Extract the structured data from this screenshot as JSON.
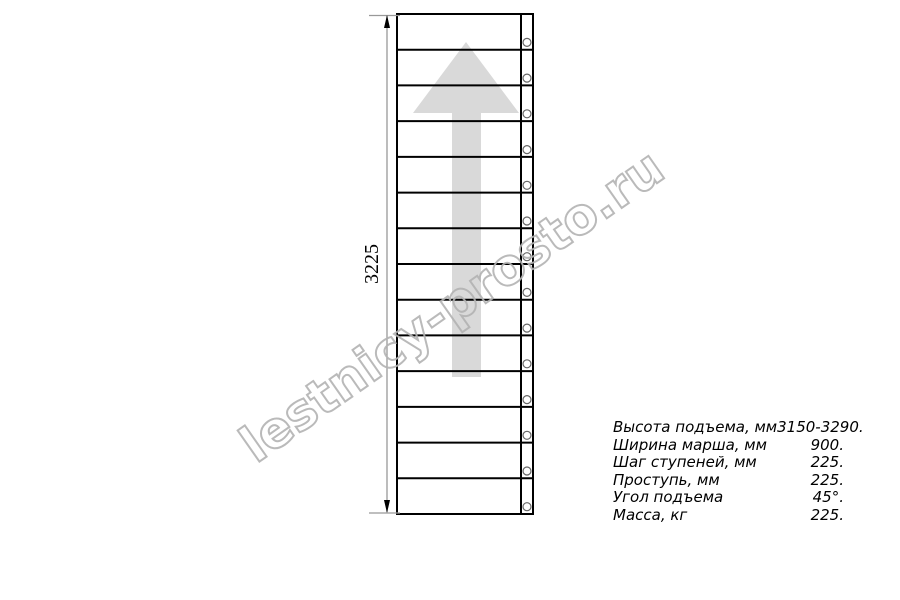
{
  "drawing": {
    "dimension_label": "3225",
    "steps_count": 14,
    "bolts_count": 14,
    "arrow_direction": "up"
  },
  "watermark": {
    "text": "lestnicy-prosto.ru"
  },
  "specs": {
    "rows": [
      {
        "label": "Высота подъема, мм",
        "value": "3150-3290."
      },
      {
        "label": "Ширина марша, мм",
        "value": "900."
      },
      {
        "label": "Шаг ступеней, мм",
        "value": "225."
      },
      {
        "label": "Проступь, мм",
        "value": "225."
      },
      {
        "label": "Угол подъема",
        "value": "45°."
      },
      {
        "label": "Масса, кг",
        "value": "225."
      }
    ]
  },
  "colors": {
    "line": "#000000",
    "arrow": "#d9d9d9",
    "dimension": "#999999",
    "dimension_arrow": "#000000",
    "bolt": "#666666",
    "watermark": "#b3b3b3",
    "text": "#000000"
  }
}
